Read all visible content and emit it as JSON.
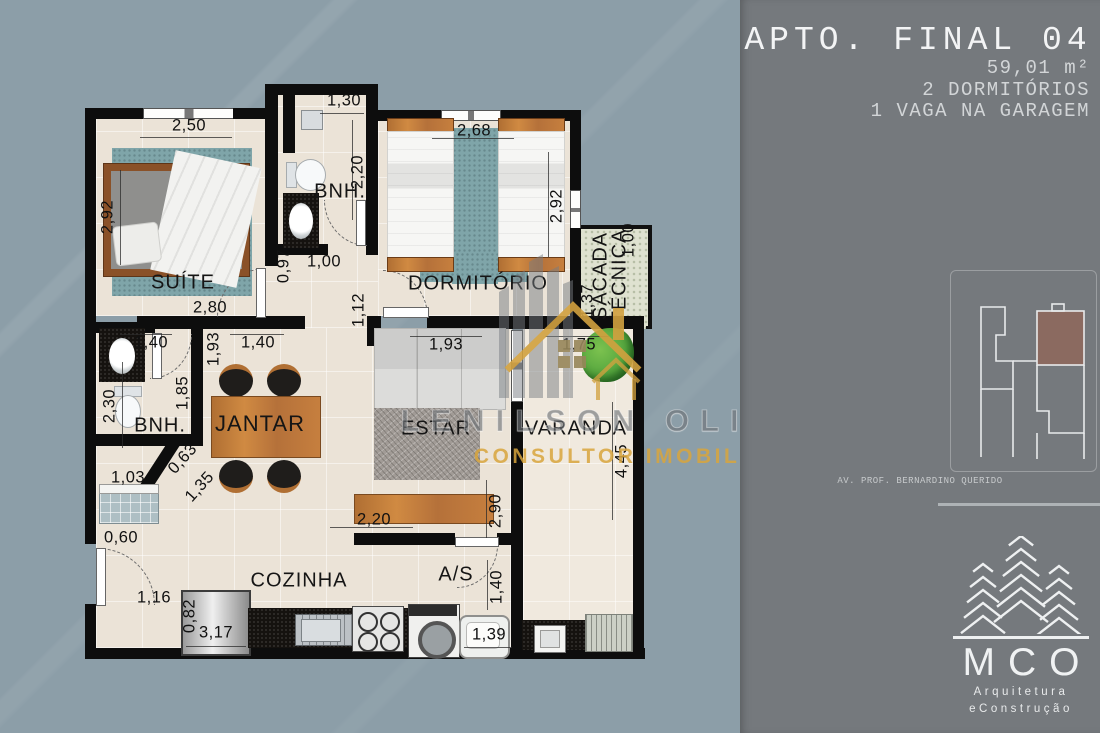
{
  "panel": {
    "title": "APTO. FINAL 04",
    "area": "59,01 m²",
    "bedrooms": "2 DORMITÓRIOS",
    "garage": "1 VAGA NA GARAGEM",
    "street": "AV. PROF. BERNARDINO QUERIDO",
    "logo_name": "MCO",
    "logo_line1": "Arquitetura",
    "logo_line2": "eConstrução",
    "keyplan_highlight_color": "#8b6a60"
  },
  "watermark": {
    "name": "LENILSON OLIVEIRA",
    "role": "CONSULTOR IMOBILIÁRIO",
    "gold": "#d2a13f"
  },
  "rooms": {
    "suite": "SUÍTE",
    "bathroom1": "BNH.",
    "bedroom": "DORMITÓRIO",
    "sacada_line1": "SACADA",
    "sacada_line2": "TÉCNICA",
    "bathroom2": "BNH.",
    "dining": "JANTAR",
    "living": "ESTAR",
    "balcony": "VARANDA",
    "kitchen": "COZINHA",
    "laundry": "A/S"
  },
  "dims": {
    "suite_top": "2,50",
    "suite_left": "2,92",
    "suite_bottom": "2,80",
    "bnh1_top": "1,30",
    "bnh1_side": "2,20",
    "bnh1_door": "1,00",
    "hall_side": "0,97",
    "dorm_top": "2,68",
    "dorm_side": "2,92",
    "dorm_pass": "1,12",
    "sacada_top": "1,00",
    "sacada_side": "1,37",
    "bnh2_top": "1,40",
    "bnh2_left": "2,30",
    "bnh2_right": "1,85",
    "bnh2_bottom": "1,03",
    "diag_small": "0,63",
    "diag_large": "1,35",
    "jantar_top": "1,40",
    "jantar_side": "1,93",
    "sofa_width": "1,93",
    "varanda_top": "1,75",
    "varanda_side": "4,45",
    "rack_width": "2,20",
    "rack_side": "2,90",
    "entry_wall": "0,60",
    "entry_door": "1,16",
    "fridge_side": "0,82",
    "kitchen_width": "3,17",
    "laundry_side": "1,40",
    "laundry_width": "1,39"
  },
  "colors": {
    "background": "#8c9ea8",
    "panel": "#75797d",
    "floor": "#ebe3d7",
    "wall": "#0d0d0d",
    "rug": "#7fa5a9",
    "wood": "#c07a3c"
  }
}
